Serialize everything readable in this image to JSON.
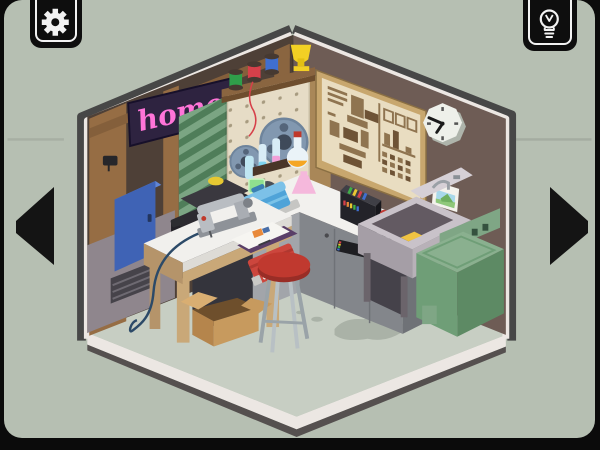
{
  "ui": {
    "settings_button": {
      "icon": "gear-icon"
    },
    "hint_button": {
      "icon": "lightbulb-icon"
    },
    "nav": {
      "previous": "left-arrow",
      "next": "right-arrow"
    }
  },
  "scene": {
    "neon_sign": {
      "text": "home",
      "text_color": "#ff74d8",
      "panel_color": "#2e2340"
    },
    "clock_time_approx": "9:50",
    "palette": {
      "background": "#b6bfb2",
      "frame": "#0b0b0b",
      "floor": "#c7cec3",
      "trim_white": "#ece7e3",
      "trim_dark": "#4a4a4a",
      "left_wall_wood": "#966d44",
      "left_wall_dark": "#4e4037",
      "right_wall": "#6e5c55",
      "counter_top": "#f2f1ee",
      "cabinet_gray": "#83868b",
      "washer_green": "#6f9e77",
      "toolbox_red": "#cc463d",
      "stool_red": "#c0392f",
      "cabinet_blue": "#3f63b5",
      "poster_paper": "#e9ddc1",
      "poster_ink": "#8f7450"
    },
    "objects": [
      "neon-home-sign",
      "pegboard-with-film-reels",
      "thread-spools",
      "yellow-trophy",
      "schematic-poster",
      "wall-clock",
      "landscape-postcard",
      "blue-wall-cabinet",
      "green-fabric-rolls",
      "sewing-machine",
      "workbench",
      "red-toolbox",
      "magazine",
      "chemistry-set",
      "blue-sewing-box",
      "film-developer",
      "red-stool",
      "cardboard-box",
      "utility-sink",
      "washing-machine",
      "floor-stain",
      "wall-vent"
    ]
  }
}
